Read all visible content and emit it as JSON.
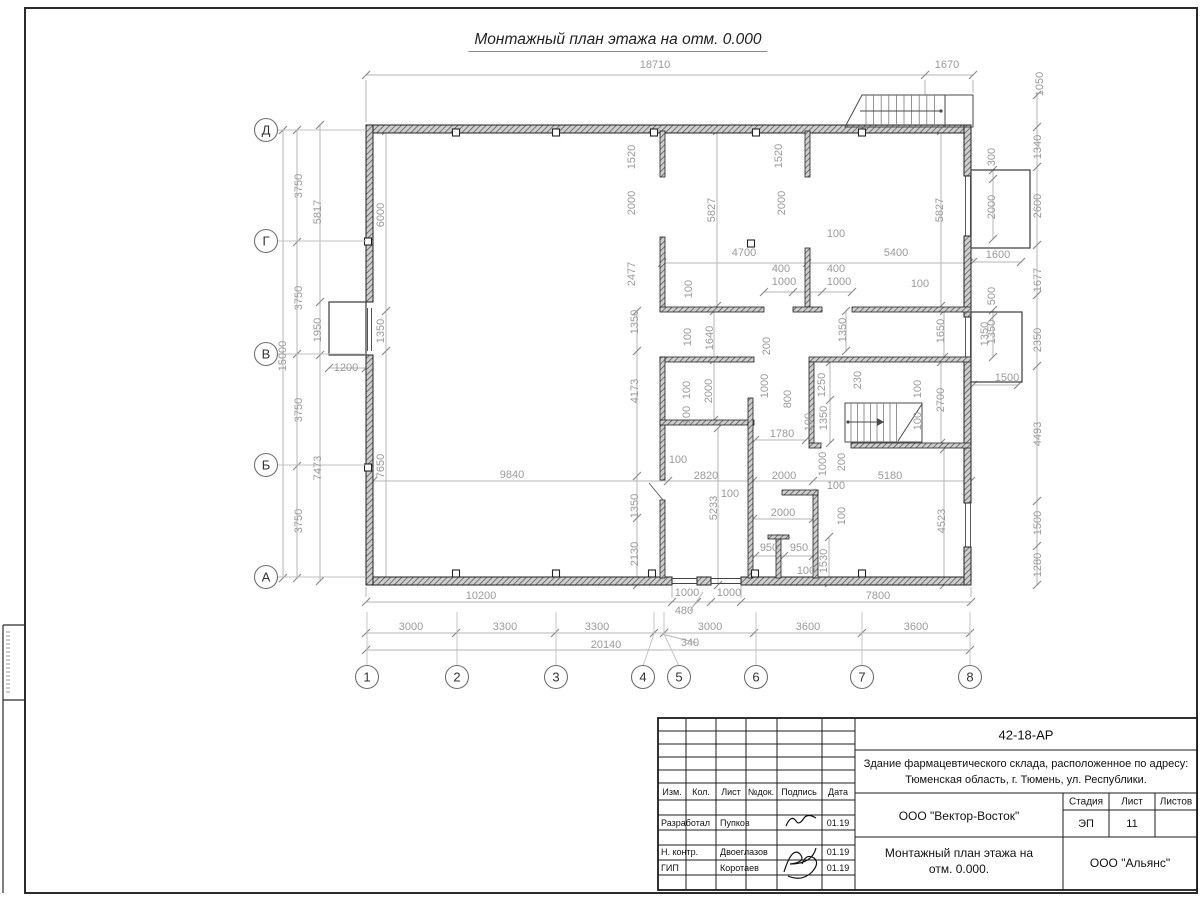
{
  "page": {
    "title": "Монтажный план этажа на отм. 0.000"
  },
  "axes": {
    "rows": [
      {
        "label": "Д",
        "y": 130
      },
      {
        "label": "Г",
        "y": 241
      },
      {
        "label": "В",
        "y": 354
      },
      {
        "label": "Б",
        "y": 465
      },
      {
        "label": "А",
        "y": 577
      }
    ],
    "cols": [
      {
        "label": "1",
        "x": 367
      },
      {
        "label": "2",
        "x": 457
      },
      {
        "label": "3",
        "x": 556
      },
      {
        "label": "4",
        "x": 654,
        "cx": 643
      },
      {
        "label": "5",
        "x": 664,
        "cx": 679
      },
      {
        "label": "6",
        "x": 756
      },
      {
        "label": "7",
        "x": 862
      },
      {
        "label": "8",
        "x": 970
      }
    ]
  },
  "dim_labels": [
    [
      "18710",
      655,
      68,
      "h"
    ],
    [
      "1670",
      947,
      68,
      "h"
    ],
    [
      "1050",
      1043,
      84,
      "v"
    ],
    [
      "3750",
      302,
      186,
      "v"
    ],
    [
      "3750",
      302,
      298,
      "v"
    ],
    [
      "3750",
      302,
      410,
      "v"
    ],
    [
      "3750",
      302,
      521,
      "v"
    ],
    [
      "15000",
      286,
      356,
      "v"
    ],
    [
      "5817",
      321,
      212,
      "v"
    ],
    [
      "1950",
      321,
      330,
      "v"
    ],
    [
      "7473",
      321,
      468,
      "v"
    ],
    [
      "1200",
      346,
      371,
      "h"
    ],
    [
      "6000",
      384,
      215,
      "v"
    ],
    [
      "1350",
      384,
      331,
      "v"
    ],
    [
      "7650",
      384,
      466,
      "v"
    ],
    [
      "1340",
      1041,
      147,
      "v"
    ],
    [
      "2600",
      1041,
      206,
      "v"
    ],
    [
      "1677",
      1041,
      280,
      "v"
    ],
    [
      "2350",
      1041,
      340,
      "v"
    ],
    [
      "4493",
      1041,
      434,
      "v"
    ],
    [
      "1500",
      1041,
      523,
      "v"
    ],
    [
      "1280",
      1041,
      565,
      "v"
    ],
    [
      "300",
      995,
      157,
      "v"
    ],
    [
      "2000",
      995,
      207,
      "v"
    ],
    [
      "1600",
      998,
      258,
      "h"
    ],
    [
      "500",
      995,
      296,
      "v"
    ],
    [
      "1350",
      995,
      332,
      "v"
    ],
    [
      "1500",
      1007,
      381,
      "h"
    ],
    [
      "10200",
      481,
      599,
      "h"
    ],
    [
      "1000",
      687,
      596,
      "h"
    ],
    [
      "1000",
      729,
      596,
      "h"
    ],
    [
      "480",
      684,
      614,
      "h"
    ],
    [
      "7800",
      878,
      599,
      "h"
    ],
    [
      "3000",
      411,
      630,
      "h"
    ],
    [
      "3300",
      505,
      630,
      "h"
    ],
    [
      "3300",
      597,
      630,
      "h"
    ],
    [
      "3000",
      710,
      630,
      "h"
    ],
    [
      "3600",
      808,
      630,
      "h"
    ],
    [
      "3600",
      916,
      630,
      "h"
    ],
    [
      "20140",
      606,
      648,
      "h"
    ],
    [
      "340",
      690,
      646,
      "h"
    ],
    [
      "1520",
      635,
      157,
      "v"
    ],
    [
      "2000",
      635,
      203,
      "v"
    ],
    [
      "2477",
      635,
      274,
      "v"
    ],
    [
      "5827",
      715,
      210,
      "v"
    ],
    [
      "1520",
      782,
      156,
      "v"
    ],
    [
      "2000",
      785,
      203,
      "v"
    ],
    [
      "5827",
      943,
      210,
      "v"
    ],
    [
      "100",
      836,
      237,
      "h"
    ],
    [
      "4700",
      744,
      256,
      "h"
    ],
    [
      "5400",
      896,
      256,
      "h"
    ],
    [
      "400",
      781,
      272,
      "h"
    ],
    [
      "1000",
      784,
      285,
      "h"
    ],
    [
      "400",
      836,
      272,
      "h"
    ],
    [
      "1000",
      839,
      285,
      "h"
    ],
    [
      "100",
      920,
      287,
      "h"
    ],
    [
      "100",
      692,
      289,
      "v"
    ],
    [
      "1350",
      638,
      322,
      "v"
    ],
    [
      "100",
      691,
      337,
      "v"
    ],
    [
      "1640",
      713,
      338,
      "v"
    ],
    [
      "1350",
      846,
      330,
      "v"
    ],
    [
      "1650",
      944,
      331,
      "v"
    ],
    [
      "1350",
      988,
      334,
      "v"
    ],
    [
      "4173",
      638,
      391,
      "v"
    ],
    [
      "100",
      690,
      390,
      "v"
    ],
    [
      "2000",
      712,
      391,
      "v"
    ],
    [
      "100",
      690,
      415,
      "v"
    ],
    [
      "200",
      770,
      346,
      "v"
    ],
    [
      "1000",
      768,
      386,
      "v"
    ],
    [
      "800",
      791,
      399,
      "v"
    ],
    [
      "1250",
      825,
      385,
      "v"
    ],
    [
      "1350",
      827,
      418,
      "v"
    ],
    [
      "100",
      812,
      422,
      "v"
    ],
    [
      "230",
      861,
      380,
      "v"
    ],
    [
      "100",
      921,
      389,
      "v"
    ],
    [
      "2700",
      944,
      400,
      "v"
    ],
    [
      "100",
      921,
      421,
      "v"
    ],
    [
      "1780",
      782,
      437,
      "h"
    ],
    [
      "9840",
      512,
      478,
      "h"
    ],
    [
      "2820",
      706,
      479,
      "h"
    ],
    [
      "2000",
      784,
      479,
      "h"
    ],
    [
      "5180",
      890,
      479,
      "h"
    ],
    [
      "100",
      678,
      463,
      "h"
    ],
    [
      "1000",
      826,
      464,
      "v"
    ],
    [
      "200",
      845,
      462,
      "v"
    ],
    [
      "100",
      836,
      489,
      "h"
    ],
    [
      "100",
      845,
      516,
      "v"
    ],
    [
      "1350",
      638,
      506,
      "v"
    ],
    [
      "5233",
      717,
      508,
      "v"
    ],
    [
      "2130",
      638,
      554,
      "v"
    ],
    [
      "100",
      730,
      497,
      "h"
    ],
    [
      "2000",
      783,
      516,
      "h"
    ],
    [
      "950",
      769,
      551,
      "h"
    ],
    [
      "950",
      799,
      551,
      "h"
    ],
    [
      "100",
      806,
      574,
      "h"
    ],
    [
      "1530",
      827,
      561,
      "v"
    ],
    [
      "4523",
      945,
      521,
      "v"
    ]
  ],
  "title_block": {
    "doc_number": "42-18-АР",
    "project_line1": "Здание фармацевтического склада, расположенное по адресу:",
    "project_line2": "Тюменская область, г. Тюмень, ул. Республики.",
    "org": "ООО \"Вектор-Восток\"",
    "sheet_title_line1": "Монтажный план этажа на",
    "sheet_title_line2": "отм. 0.000.",
    "client_org": "ООО \"Альянс\"",
    "stage_label": "Стадия",
    "sheet_label": "Лист",
    "sheets_label": "Листов",
    "stage": "ЭП",
    "sheet_no": "11",
    "sheets_total": "",
    "header_cells": [
      "Изм.",
      "Кол.",
      "Лист",
      "№док.",
      "Подпись",
      "Дата"
    ],
    "rows": [
      {
        "role": "Разработал",
        "name": "Пупков",
        "date": "01.19"
      },
      {
        "role": "Н. контр.",
        "name": "Двоеглазов",
        "date": "01.19"
      },
      {
        "role": "ГИП",
        "name": "Коротаев",
        "date": "01.19"
      }
    ]
  }
}
